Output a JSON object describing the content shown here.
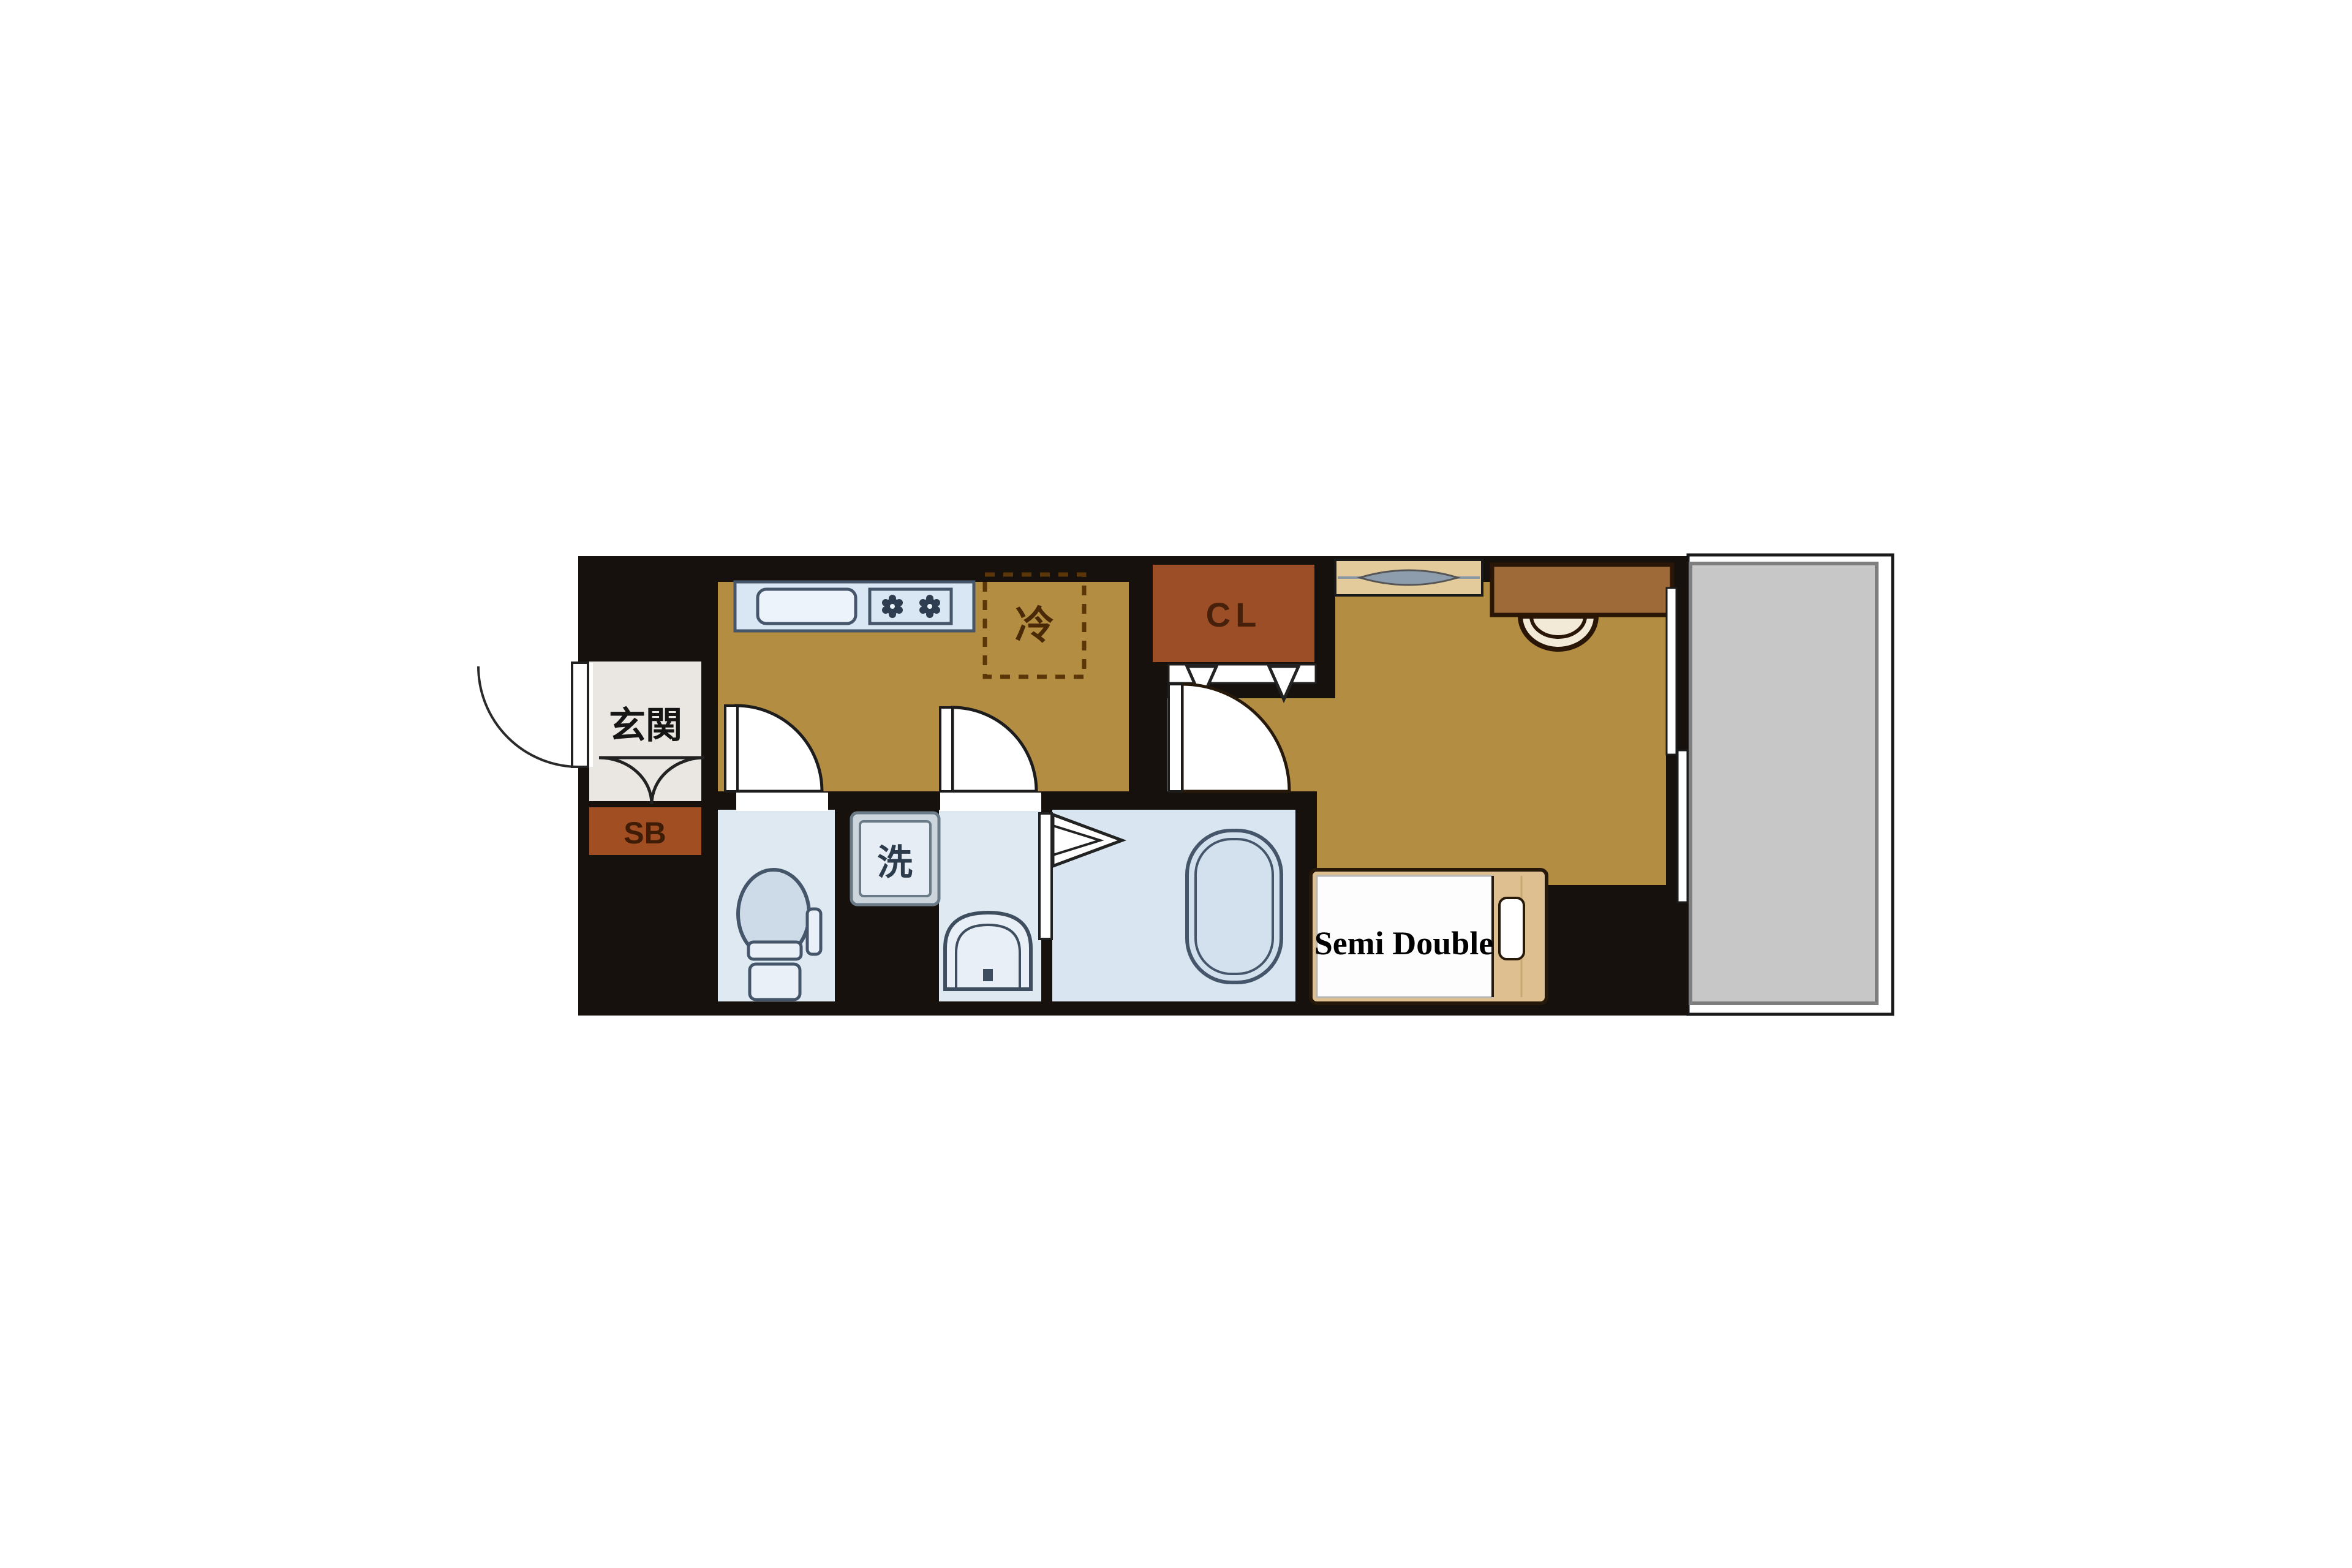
{
  "floorplan": {
    "title": "one-room apartment floor plan",
    "entrance": {
      "label": "玄関",
      "shoebox_label": "SB"
    },
    "kitchen": {
      "fridge_label": "冷"
    },
    "closet": {
      "label": "CL"
    },
    "sanitary": {
      "washer_label": "洗"
    },
    "bedroom": {
      "bed_label": "Semi Double"
    },
    "colors": {
      "wall": "#16110c",
      "floor_wood": "#b38d41",
      "floor_entrance": "#eae7e2",
      "floor_wet": "#dfe9f2",
      "floor_bath": "#d9e6f1",
      "closet_brown": "#9c4e26",
      "shoebox_brown": "#a04e22",
      "desk_brown": "#9d6a38",
      "bed_frame_tan": "#ddbf90",
      "counter_blue": "#d9e7f5",
      "fixture_blue": "#e9f0f7",
      "balcony_gray": "#c7c7c7",
      "window_gray": "#8d9dad",
      "fixture_stroke": "#46566a",
      "dark_brown_text": "#46200a"
    }
  }
}
